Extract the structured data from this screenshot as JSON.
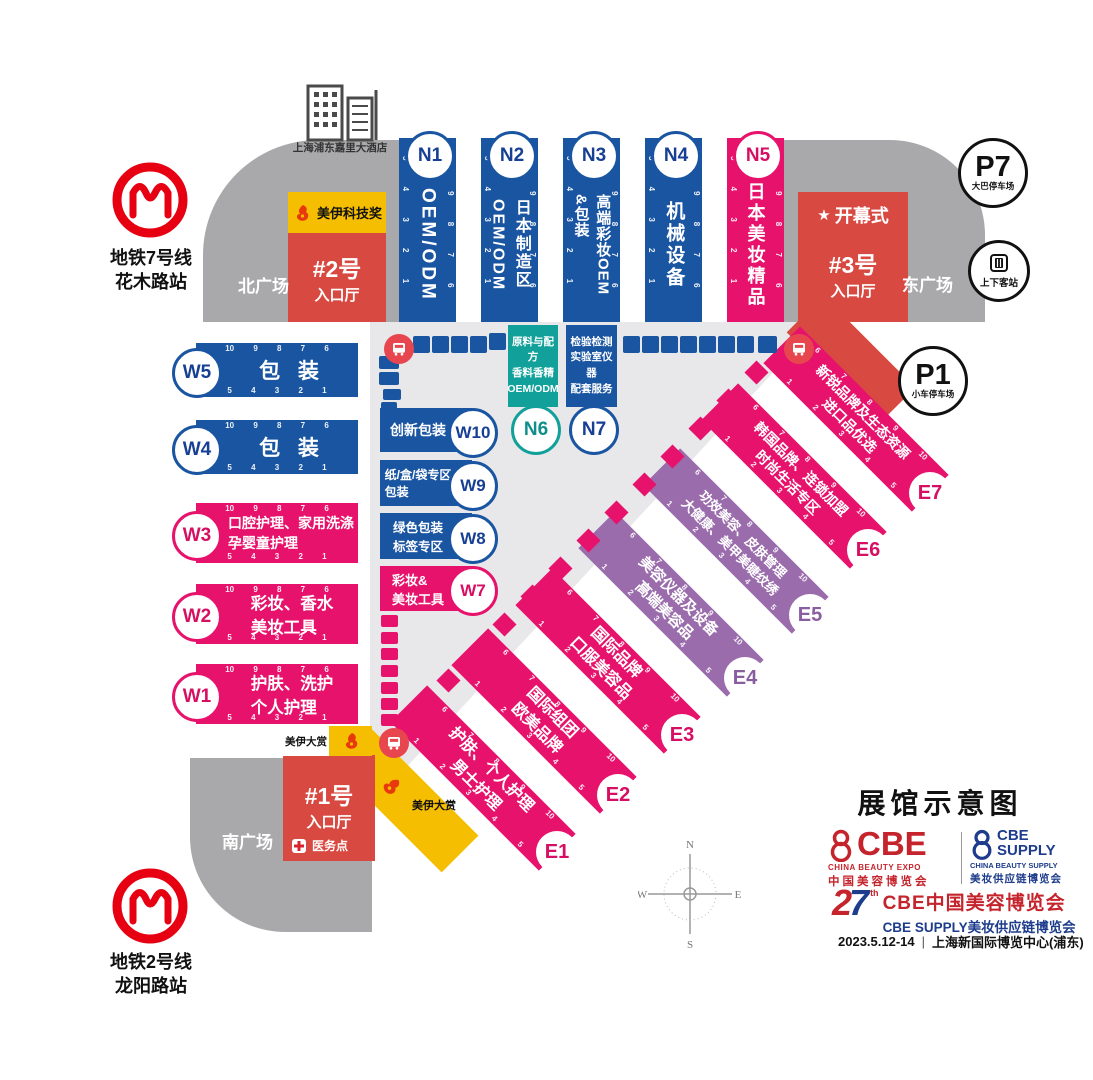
{
  "title": "展馆示意图",
  "hotel_label": "上海浦东嘉里大酒店",
  "metro": {
    "line7": "地铁7号线\n花木路站",
    "line2": "地铁2号线\n龙阳路站"
  },
  "plazas": {
    "north": "北广场",
    "east": "东广场",
    "south": "南广场"
  },
  "entrance_halls": {
    "no1": {
      "no": "#1号",
      "hall": "入口厅"
    },
    "no2": {
      "no": "#2号",
      "hall": "入口厅"
    },
    "no3": {
      "no": "#3号",
      "hall": "入口厅"
    }
  },
  "opening_star": "★",
  "opening_ceremony": "开幕式",
  "awards": {
    "tech": "美伊科技奖",
    "grand1": "美伊大赏",
    "grand2": "美伊大赏"
  },
  "medical": "医务点",
  "parking": {
    "p7": "P7",
    "p7_label": "大巴停车场",
    "p1": "P1",
    "p1_label": "小车停车场",
    "station_label": "上下客站"
  },
  "n_halls": [
    {
      "id": "N1",
      "label": "OEM/ODM",
      "left_nums": "5 4 3 2 1",
      "right_nums": "10 9 8 7 6"
    },
    {
      "id": "N2",
      "label": "日本制造区\nOEM/ODM",
      "left_nums": "5 4 3 2 1",
      "right_nums": "10 9 8 7 6"
    },
    {
      "id": "N3",
      "label": "高端彩妆OEM\n&包装",
      "left_nums": "5 4 3 2 1",
      "right_nums": "10 9 8 7 6"
    },
    {
      "id": "N4",
      "label": "机械设备",
      "left_nums": "5 4 3 2 1",
      "right_nums": "10 9 8 7 6"
    },
    {
      "id": "N5",
      "label": "日本美妆精品",
      "left_nums": "5 4 3 2 1",
      "right_nums": "10 9 8 7 6"
    }
  ],
  "n_annex": [
    {
      "id": "N6",
      "label": "原料与配方\n香料香精\nOEM/ODM"
    },
    {
      "id": "N7",
      "label": "检验检测\n实验室仪器\n配套服务"
    }
  ],
  "w_halls": [
    {
      "id": "W5",
      "label": "包 装",
      "top_nums": "10 9 8 7 6",
      "bottom_nums": "5 4 3 2 1"
    },
    {
      "id": "W4",
      "label": "包 装",
      "top_nums": "10 9 8 7 6",
      "bottom_nums": "5 4 3 2 1"
    },
    {
      "id": "W3",
      "label": "口腔护理、家用洗涤\n孕婴童护理",
      "top_nums": "10 9 8 7 6",
      "bottom_nums": "5 4 3 2 1"
    },
    {
      "id": "W2",
      "label": "彩妆、香水\n美妆工具",
      "top_nums": "10 9 8 7 6",
      "bottom_nums": "5 4 3 2 1"
    },
    {
      "id": "W1",
      "label": "护肤、洗护\n个人护理",
      "top_nums": "10 9 8 7 6",
      "bottom_nums": "5 4 3 2 1"
    }
  ],
  "w_annex": [
    {
      "id": "W10",
      "label": "创新包装"
    },
    {
      "id": "W9",
      "label": "纸/盒/袋专区\n包装"
    },
    {
      "id": "W8",
      "label": "绿色包装\n标签专区"
    },
    {
      "id": "W7",
      "label": "彩妆&\n美妆工具"
    }
  ],
  "e_halls": [
    {
      "id": "E1",
      "label": "护肤、个人护理\n男士护理",
      "top_nums": "6 7 8 9 10",
      "bottom_nums": "1 2 3 4 5"
    },
    {
      "id": "E2",
      "label": "国际组团\n欧美品牌",
      "top_nums": "6 7 8 9 10",
      "bottom_nums": "1 2 3 4 5"
    },
    {
      "id": "E3",
      "label": "国际品牌\n口服美容品",
      "top_nums": "6 7 8 9 10",
      "bottom_nums": "1 2 3 4 5"
    },
    {
      "id": "E4",
      "label": "美容仪器及设备\n高端美容品",
      "top_nums": "6 7 8 9 10",
      "bottom_nums": "1 2 3 4 5"
    },
    {
      "id": "E5",
      "label": "功效美容、皮肤管理\n大健康、美甲美睫纹绣",
      "top_nums": "6 7 8 9 10",
      "bottom_nums": "1 2 3 4 5"
    },
    {
      "id": "E6",
      "label": "韩国品牌、连锁加盟\n时尚生活专区",
      "top_nums": "6 7 8 9 10",
      "bottom_nums": "1 2 3 4 5"
    },
    {
      "id": "E7",
      "label": "新锐品牌及生态资源\n进口品优选",
      "top_nums": "6 7 8 9 10",
      "bottom_nums": "1 2 3 4 5"
    }
  ],
  "compass": {
    "n": "N",
    "e": "E",
    "s": "S",
    "w": "W"
  },
  "branding": {
    "cbe": {
      "name": "CBE",
      "en": "CHINA BEAUTY EXPO",
      "cn": "中国美容博览会"
    },
    "supply": {
      "name": "CBE\nSUPPLY",
      "en": "CHINA BEAUTY SUPPLY",
      "cn": "美妆供应链博览会"
    },
    "edition_2": "2",
    "edition_7": "7",
    "edition_sup": "th",
    "line1": "CBE中国美容博览会",
    "line2": "CBE SUPPLY美妆供应链博览会",
    "date": "2023.5.12-14",
    "sep": "|",
    "venue": "上海新国际博览中心(浦东)"
  },
  "colors": {
    "hall_blue": "#1a55a2",
    "hall_pink": "#e6126b",
    "hall_purple": "#9a6cac",
    "hall_teal": "#12a19a",
    "entrance_red": "#d84a41",
    "award_yellow": "#f6be00",
    "plaza_gray": "#a9a9ac",
    "corridor_gray": "#e8e8ea",
    "metro_red": "#e60012",
    "brand_red": "#c5242c",
    "brand_blue": "#1e3c8c"
  }
}
